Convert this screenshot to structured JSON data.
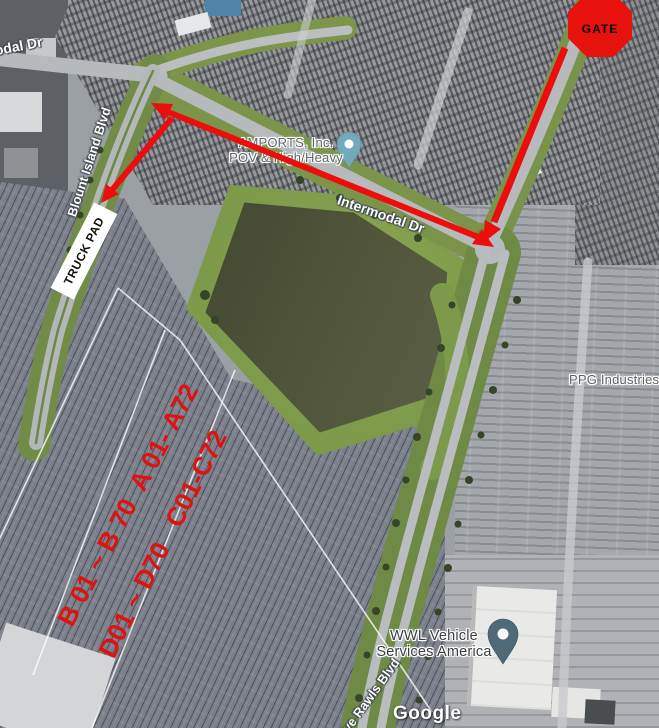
{
  "map": {
    "street_labels": {
      "intermodal_left": "Intermodal Dr",
      "blount_island": "Blount Island Blvd",
      "intermodal_mid": "Intermodal Dr",
      "dave_rawls": "Dave Rawls Blvd"
    },
    "poi": {
      "amports": {
        "line1": "AMPORTS, Inc.",
        "line2": "POV & High/Heavy",
        "pin_color": "#74a9bb"
      },
      "ppg": {
        "text": "PPG Industries"
      },
      "wwl": {
        "line1": "WWL Vehicle",
        "line2": "Services America",
        "pin_color": "#4e6a78"
      }
    },
    "watermark": "Google"
  },
  "annotations": {
    "gate": {
      "label": "GATE",
      "fill": "#e8120c"
    },
    "truck_pad": {
      "label": "TRUCK PAD"
    },
    "lot_rows": {
      "line1": "B 01 ~ B 70  A 01- A72",
      "line2": "D01 ~ D70   C01-C72",
      "text_color": "#e01111"
    },
    "arrow_color": "#ec0d0d",
    "colors": {
      "pond": "#51563b",
      "grass": "#7d9a4a",
      "road": "#b7babd"
    }
  }
}
